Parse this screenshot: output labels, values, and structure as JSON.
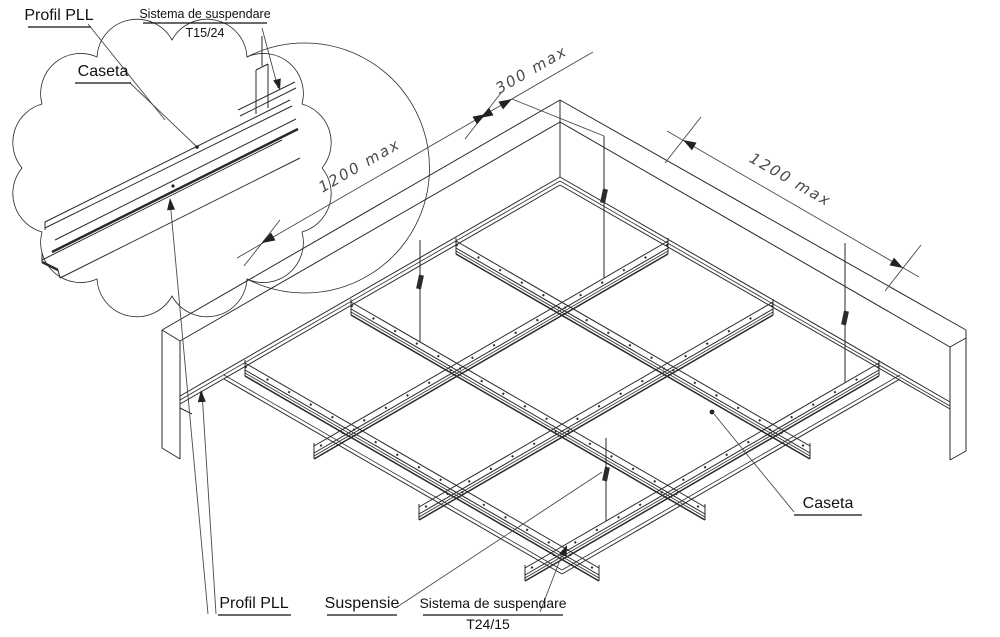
{
  "detail_callout": {
    "profil_pll": "Profil PLL",
    "sistema_line1": "Sistema de suspendare",
    "sistema_line2": "T15/24",
    "caseta": "Caseta"
  },
  "dimensions": {
    "hanger_offset": "300 max",
    "module_left": "1200 max",
    "module_right": "1200 max"
  },
  "main_callouts": {
    "caseta": "Caseta",
    "profil_pll": "Profil PLL",
    "suspensie": "Suspensie",
    "sistema_line1": "Sistema de suspendare",
    "sistema_line2": "T24/15"
  },
  "colors": {
    "line": "#2a2a2a",
    "dimension_text": "#4a4a4a",
    "label_text": "#111111",
    "background": "#ffffff"
  }
}
